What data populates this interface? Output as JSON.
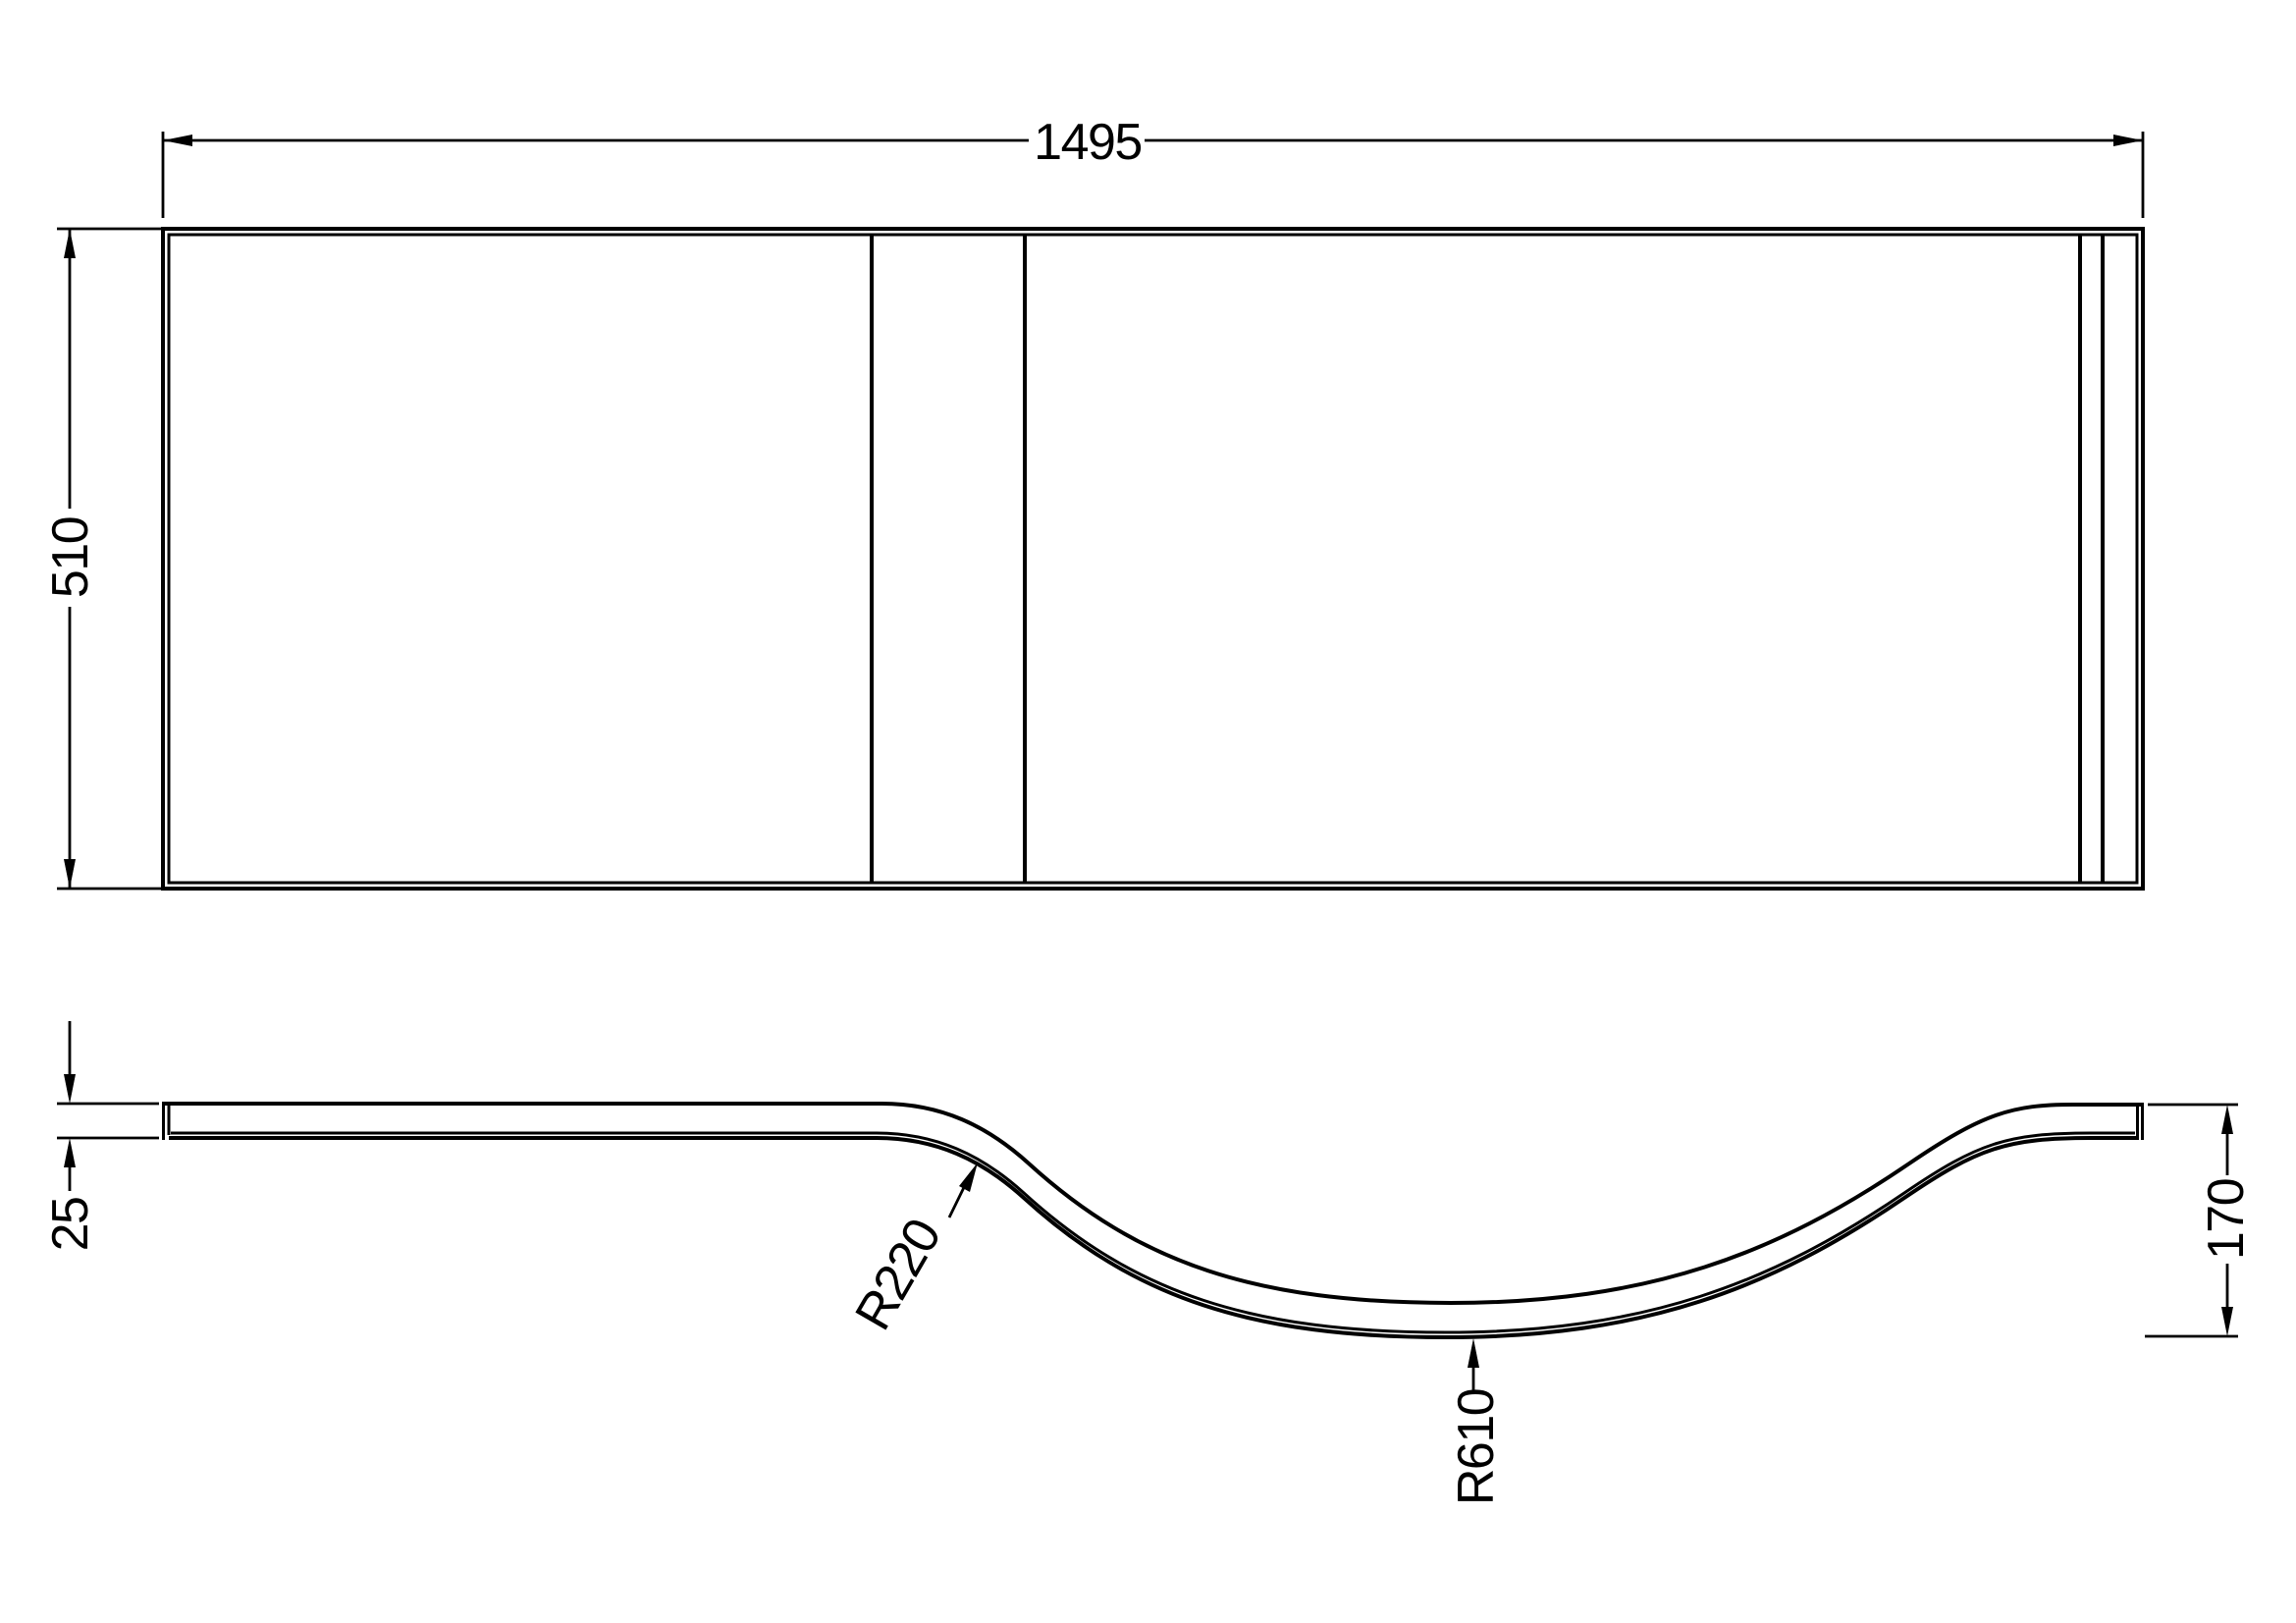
{
  "drawing": {
    "background_color": "#ffffff",
    "line_color": "#000000",
    "front_view": {
      "width_dim": "1495",
      "height_dim": "510"
    },
    "plan_view": {
      "thickness_dim": "25",
      "depth_dim": "170",
      "radius_transition": "R220",
      "radius_bowl": "R610"
    }
  }
}
